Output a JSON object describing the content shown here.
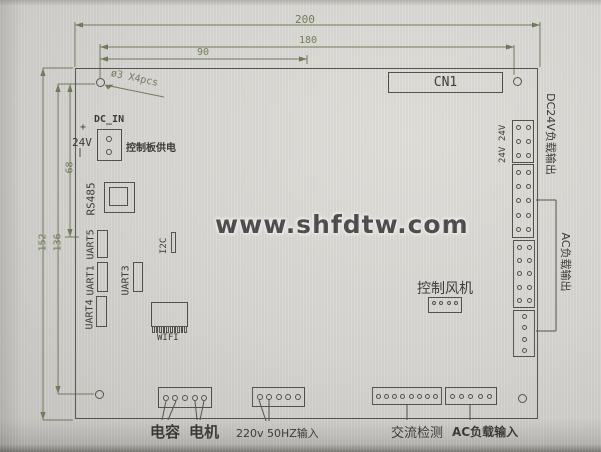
{
  "watermark": "www.shfdtw.com",
  "dims": {
    "d200": "200",
    "d180": "180",
    "d90": "90",
    "d152": "152",
    "d136": "136",
    "d68": "68",
    "hole_note": "ø3 X4pcs"
  },
  "labels": {
    "cn1": "CN1",
    "dc_in": "DC_IN",
    "plus": "+",
    "v24_dcin": "24V",
    "board_power": "控制板供电",
    "rs485": "RS485",
    "uart5": "UART5",
    "uart1": "UART1",
    "uart4": "UART4",
    "uart3": "UART3",
    "i2c": "I2C",
    "wifi": "WIFI",
    "fan_ctrl": "控制风机",
    "v24_a": "24V",
    "v24_b": "24V",
    "dc24_out": "DC24V负载输出",
    "ac_out": "AC负载输出",
    "cap": "电容",
    "motor": "电机",
    "ac_in_220": "220v 50HZ输入",
    "ac_detect": "交流检测",
    "ac_load_in": "AC负载输入"
  },
  "colors": {
    "dimension": "#6f7a59",
    "outline": "#52504b",
    "paper": "#d7d5d1",
    "watermark_text": "#4c4c4c"
  }
}
